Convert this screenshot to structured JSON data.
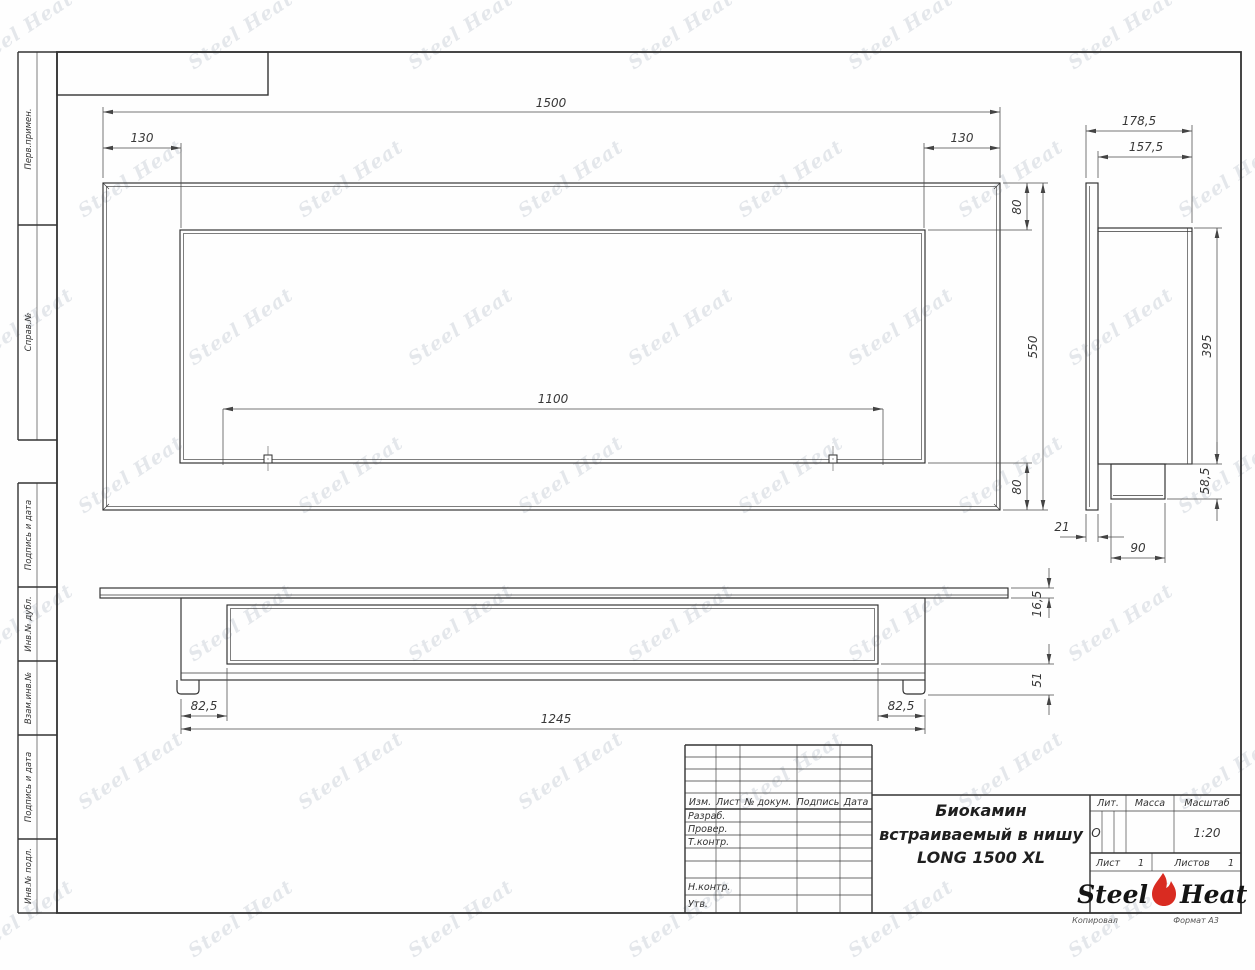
{
  "sheet": {
    "watermark_text": "Steel Heat"
  },
  "sidebar": {
    "items": [
      {
        "label": "Перв.примен."
      },
      {
        "label": "Справ.№"
      },
      {
        "label": "Подпись и дата"
      },
      {
        "label": "Инв.№ дубл."
      },
      {
        "label": "Взам.инв.№"
      },
      {
        "label": "Подпись и дата"
      },
      {
        "label": "Инв.№ подл."
      }
    ]
  },
  "views": {
    "front": {
      "dims": {
        "overall_width": "1500",
        "left_inset": "130",
        "right_inset": "130",
        "opening_width": "1100",
        "top_margin": "80",
        "overall_height": "550",
        "bottom_margin": "80"
      }
    },
    "side": {
      "dims": {
        "overall_depth": "178,5",
        "body_depth": "157,5",
        "body_height": "395",
        "spigot_height": "58,5",
        "spigot_width": "90",
        "flange_thickness": "21"
      }
    },
    "bottom": {
      "dims": {
        "left_inset": "82,5",
        "body_length": "1245",
        "right_inset": "82,5",
        "plate_thickness": "16,5",
        "underside_height": "51"
      }
    }
  },
  "title_block": {
    "rev_columns": [
      {
        "label": "Изм."
      },
      {
        "label": "Лист"
      },
      {
        "label": "№ докум."
      },
      {
        "label": "Подпись"
      },
      {
        "label": "Дата"
      }
    ],
    "rows": [
      {
        "label": "Разраб."
      },
      {
        "label": "Провер."
      },
      {
        "label": "Т.контр."
      },
      {
        "label": "Н.контр."
      },
      {
        "label": "Утв."
      }
    ],
    "title_line1": "Биокамин",
    "title_line2": "встраиваемый в нишу",
    "title_line3": "LONG 1500 XL",
    "lit_label": "Лит.",
    "lit_value": "О",
    "mass_label": "Масса",
    "scale_label": "Масштаб",
    "scale_value": "1:20",
    "sheet_label": "Лист",
    "sheet_value": "1",
    "sheets_label": "Листов",
    "sheets_value": "1",
    "logo": {
      "steel": "Steel",
      "heat": "Heat"
    },
    "footer": {
      "copied": "Копировал",
      "format": "Формат А3"
    }
  },
  "colors": {
    "line": "#2e2e2e",
    "dim": "#4a4a4a",
    "accent_red": "#d92b21",
    "watermark": "#aab3c0"
  }
}
